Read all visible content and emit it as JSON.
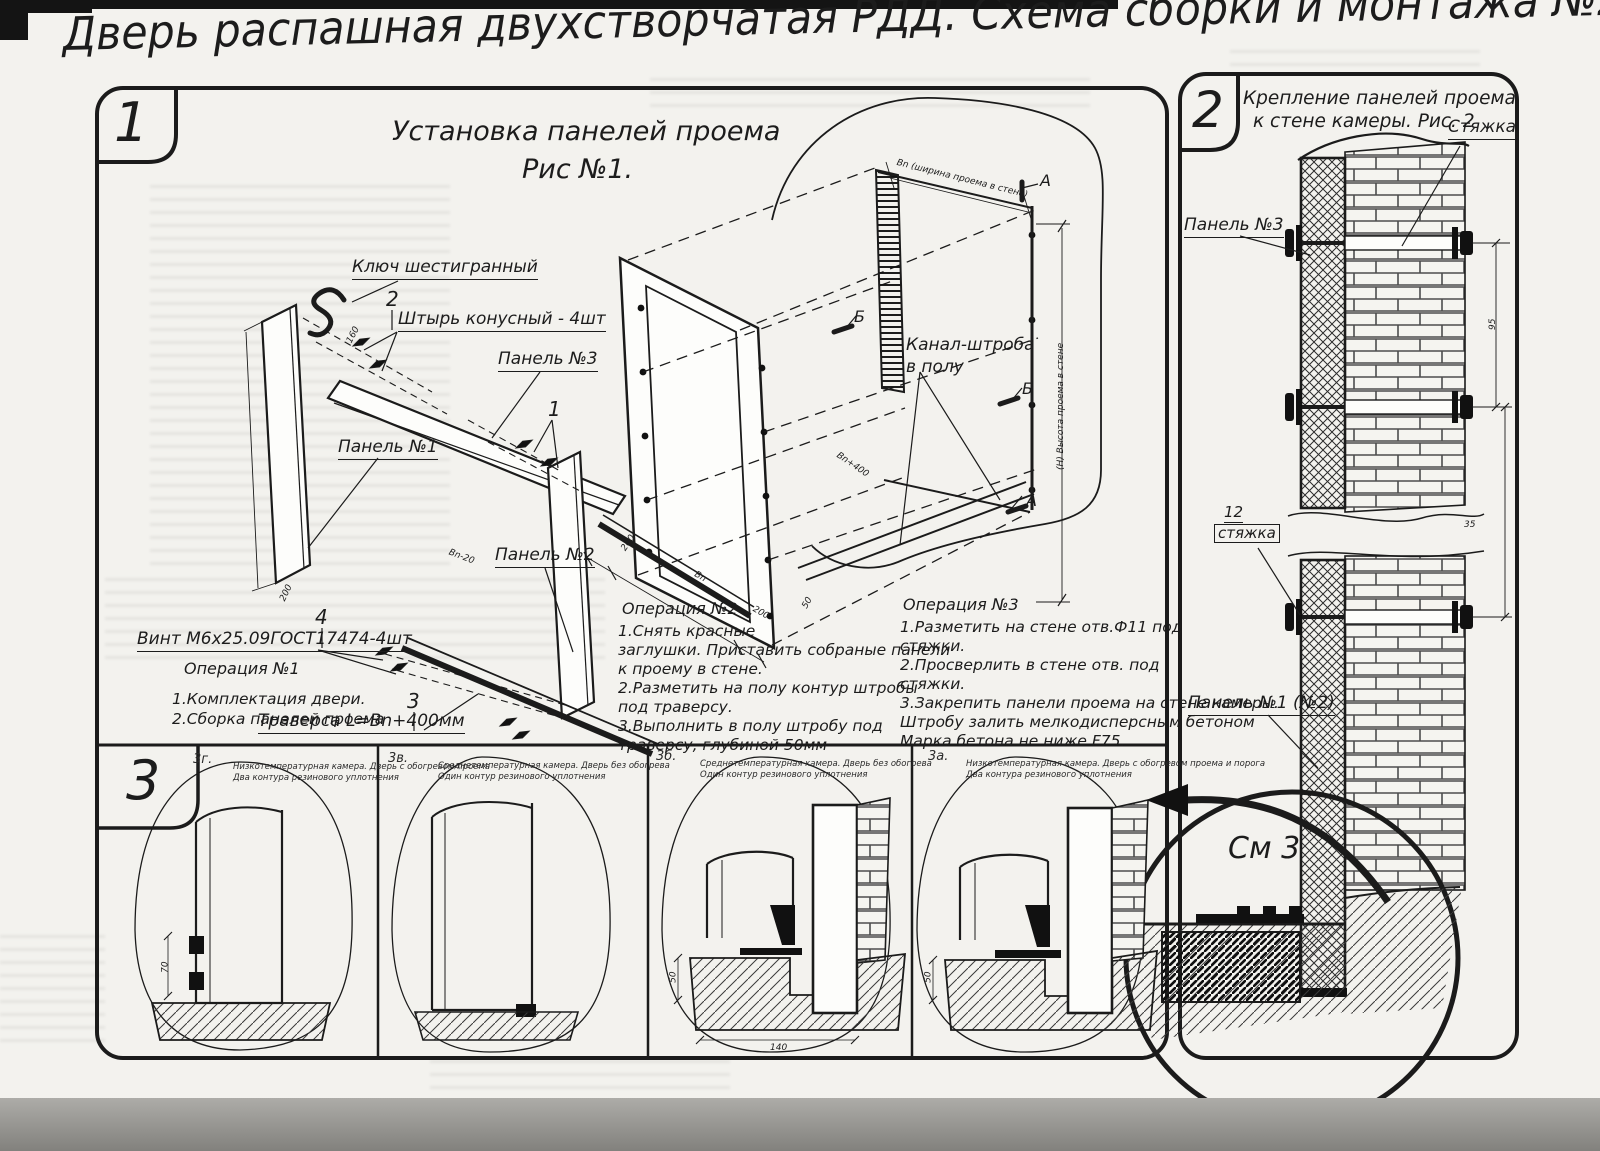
{
  "title": "Дверь распашная двухстворчатая РДД.  Схема сборки и монтажа №2",
  "fig1": {
    "section_number": "1",
    "title_line1": "Установка панелей проема",
    "title_line2": "Рис №1.",
    "callout_hex_key": "Ключ шестигранный",
    "callout_pin_number": "2",
    "callout_pin": "Штырь конусный - 4шт",
    "callout_panel3": "Панель №3",
    "callout_item1_number": "1",
    "callout_panel1": "Панель №1",
    "callout_panel2": "Панель №2",
    "callout_screw_number": "4",
    "callout_screw": "Винт М6х25.09ГОСТ17474-4шт",
    "callout_traverse_number": "3",
    "callout_traverse": "Траверса  L=Bn+400мм",
    "callout_channel_line1": "Канал-штроба",
    "callout_channel_line2": "в полу",
    "dim_opening_width": "Bn (ширина проема в стене)",
    "dim_opening_height": "(Н) Высота проема в стене",
    "dim_bn20": "Bn-20",
    "dim_160": "160",
    "dim_200a": "200",
    "dim_200b": "200",
    "dim_200c": "200",
    "dim_bn": "Bn",
    "dim_50": "50",
    "dim_bn400": "Bn+400",
    "marker_a_top": "А",
    "marker_a_bottom": "А",
    "marker_b_left": "Б",
    "marker_b_right": "Б",
    "op1_title": "Операция №1",
    "op1_lines": [
      "1.Комплектация двери.",
      "2.Сборка панелей проема"
    ],
    "op2_title": "Операция №2",
    "op2_lines": [
      "1.Снять красные",
      "заглушки. Приставить собраные панели",
      "к проему в стене.",
      "2.Разметить на полу контур штробы",
      "под траверсу.",
      "3.Выполнить в полу штробу под",
      "траверсу, глубиной 50мм"
    ],
    "op3_title": "Операция №3",
    "op3_lines": [
      "1.Разметить на стене отв.Ф11 под",
      "стяжки.",
      "2.Просверлить в стене отв.  под",
      "стяжки.",
      "3.Закрепить панели проема на стене камеры.",
      "Штробу залить мелкодисперсным бетоном",
      "Марка бетона не ниже  F75."
    ]
  },
  "fig2": {
    "section_number": "2",
    "title_line1": "Крепление панелей проема",
    "title_line2": "к стене камеры. Рис. 2",
    "callout_tie": "Стяжка",
    "callout_panel3": "Панель №3",
    "callout_tie12_number": "12",
    "callout_tie12": "стяжка",
    "callout_panel12": "Панель №1 (№2)",
    "see_detail": "См 3",
    "dim_35": "35",
    "dim_95": "95"
  },
  "fig3": {
    "section_number": "3",
    "panels": [
      {
        "id": "3г.",
        "caption_line1": "Низкотемпературная камера. Дверь с обогревом проема",
        "caption_line2": "Два контура резинового уплотнения",
        "dim": "70"
      },
      {
        "id": "3в.",
        "caption_line1": "Среднетемпературная камера. Дверь без обогрева",
        "caption_line2": "Один контур резинового уплотнения",
        "dim": ""
      },
      {
        "id": "3б.",
        "caption_line1": "Среднетемпературная камера. Дверь без обогрева",
        "caption_line2": "Один контур резинового уплотнения",
        "dim": "50",
        "dim2": "140"
      },
      {
        "id": "3а.",
        "caption_line1": "Низкотемпературная камера. Дверь с обогревом проема и порога",
        "caption_line2": "Два контура резинового уплотнения",
        "dim": "50"
      }
    ]
  },
  "colors": {
    "ink": "#1b1b1b",
    "paper": "#f3f2ee"
  }
}
